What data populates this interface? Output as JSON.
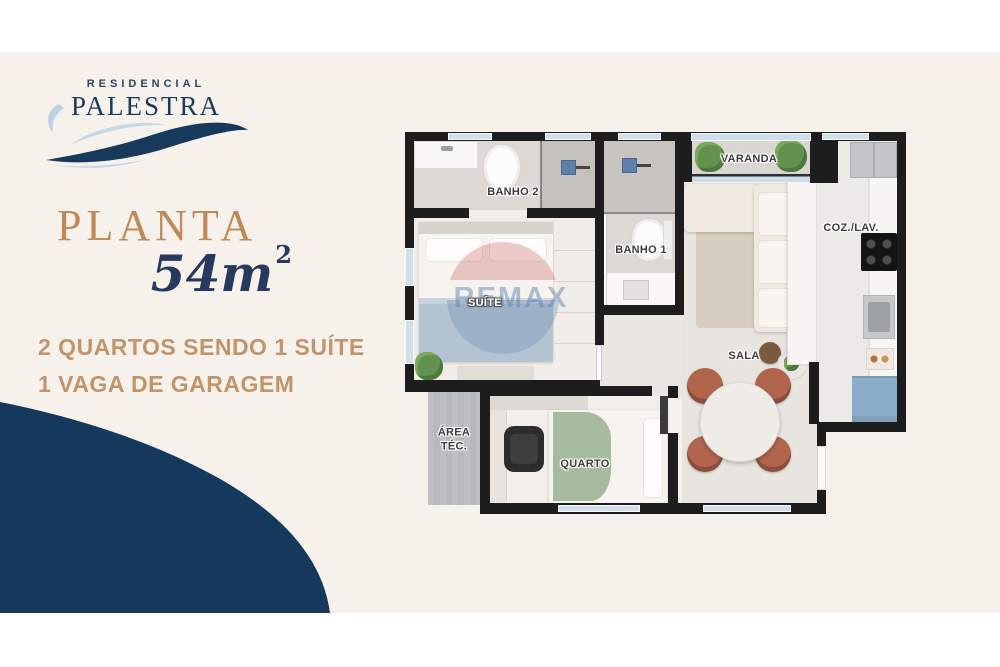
{
  "branding": {
    "residencial": "RESIDENCIAL",
    "name": "PALESTRA"
  },
  "left_panel": {
    "title": "PLANTA",
    "area_value": "54m",
    "area_sup": "2",
    "features": [
      "2 QUARTOS SENDO 1 SUÍTE",
      "1 VAGA DE GARAGEM"
    ]
  },
  "floorplan": {
    "watermark": "REMAX",
    "rooms": [
      {
        "label": "BANHO 2"
      },
      {
        "label": "BANHO 1"
      },
      {
        "label": "VARANDA"
      },
      {
        "label": "COZ./LAV."
      },
      {
        "label": "SUÍTE"
      },
      {
        "label": "SALA"
      },
      {
        "label": "QUARTO"
      },
      {
        "label": "ÁREA TÉC."
      }
    ]
  },
  "colors": {
    "background": "#ffffff",
    "canvas": "#f7f1ec",
    "navy": "#14395d",
    "gold": "#bd8a58",
    "feature_text": "#c2946c",
    "wall": "#1d1d1d",
    "logo_lightblue": "#bcd1e8"
  }
}
